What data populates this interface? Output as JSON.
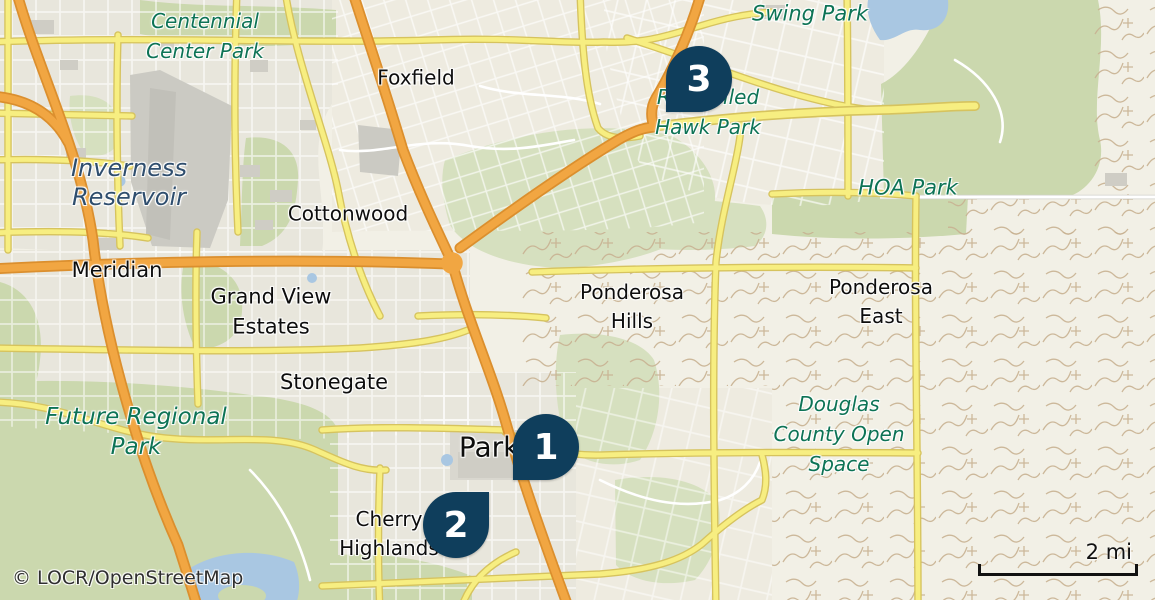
{
  "map": {
    "attribution": "© LOCR/OpenStreetMap",
    "scale_label": "2 mi"
  },
  "markers": {
    "m1": {
      "number": "1"
    },
    "m2": {
      "number": "2"
    },
    "m3": {
      "number": "3"
    }
  },
  "labels": {
    "centennial_center_park": {
      "line1": "Centennial",
      "line2": "Center Park"
    },
    "swing_park": {
      "line1": "Swing Park"
    },
    "red_tailed_hawk_park": {
      "line1": "Red-tailed",
      "line2": "Hawk Park"
    },
    "hoa_park": {
      "line1": "HOA Park"
    },
    "inverness_reservoir": {
      "line1": "Inverness",
      "line2": "Reservoir"
    },
    "foxfield": {
      "line1": "Foxfield"
    },
    "cottonwood": {
      "line1": "Cottonwood"
    },
    "meridian": {
      "line1": "Meridian"
    },
    "grand_view_estates": {
      "line1": "Grand View",
      "line2": "Estates"
    },
    "stonegate": {
      "line1": "Stonegate"
    },
    "ponderosa_hills": {
      "line1": "Ponderosa",
      "line2": "Hills"
    },
    "ponderosa_east": {
      "line1": "Ponderosa",
      "line2": "East"
    },
    "douglas_county_open_space": {
      "line1": "Douglas",
      "line2": "County Open",
      "line3": "Space"
    },
    "future_regional_park": {
      "line1": "Future Regional",
      "line2": "Park"
    },
    "parker": {
      "line1": "Parker"
    },
    "cherry_highlands": {
      "line1": "Cherry",
      "line2": "Highlands"
    }
  },
  "colors": {
    "pin": "#0f3e5c",
    "park_label": "#0d7355",
    "water_label": "#2f4e6e",
    "place_label": "#0d0d0d",
    "land": "#f2f0e6",
    "urban": "#e8e6dc",
    "urban_light": "#eeebe0",
    "green": "#cbd8ae",
    "green_light": "#d6e0bf",
    "water": "#a9c7e2",
    "airport": "#cbcac3",
    "trail": "#c8b191",
    "road_yellow": "#f7ee81",
    "road_yellow_casing": "#d6c35e",
    "motorway": "#f1a642",
    "motorway_casing": "#db8f2e",
    "scalebar": "#111111",
    "attribution_color": "#2e2e2e"
  }
}
